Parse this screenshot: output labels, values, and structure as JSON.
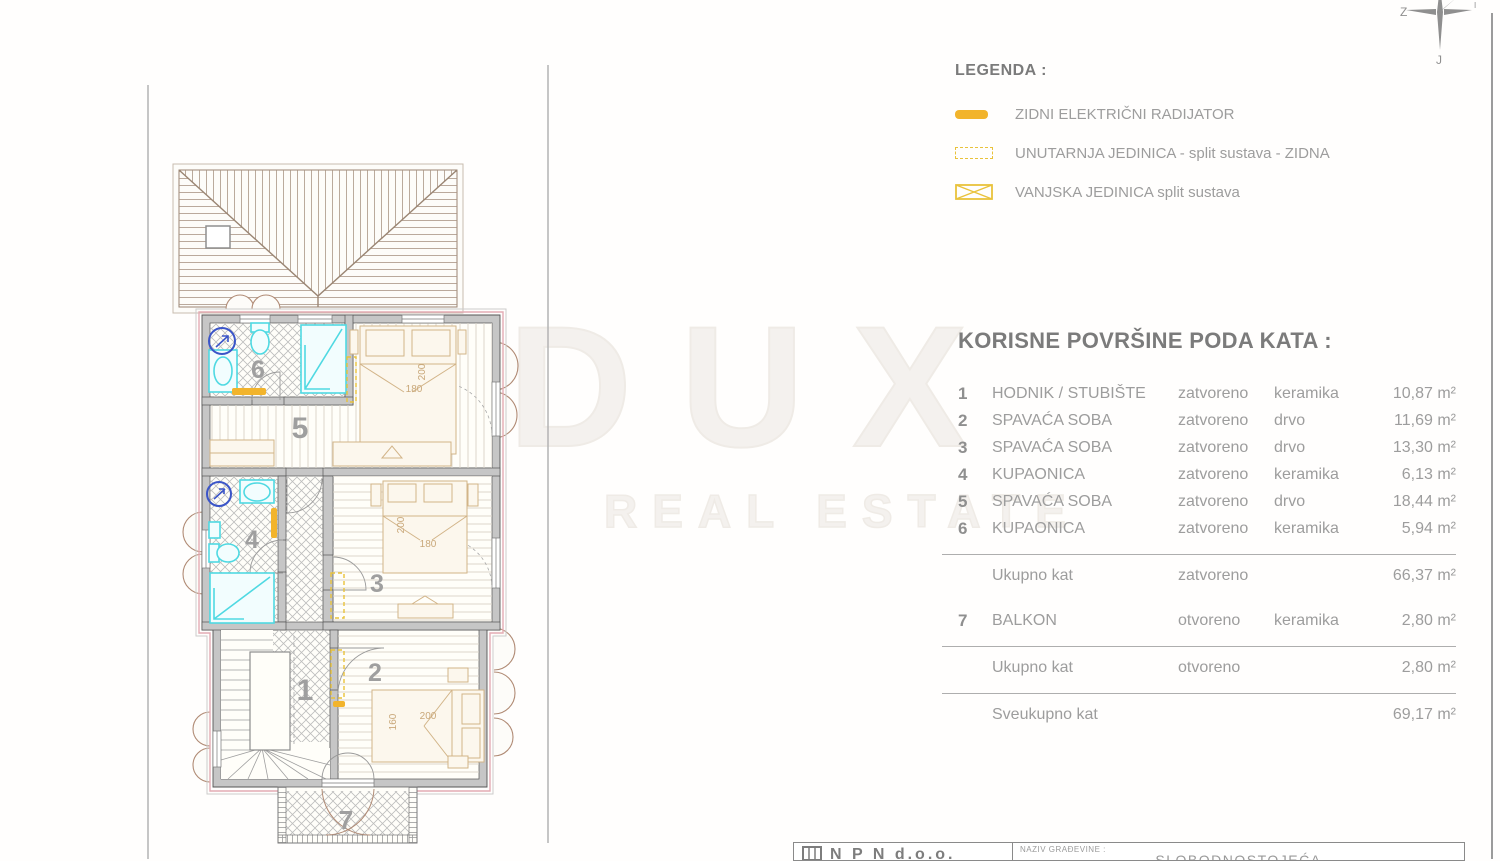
{
  "compass": {
    "west": "Z",
    "south": "J",
    "east": "I"
  },
  "legend": {
    "title": "LEGENDA :",
    "items": [
      {
        "symbol": "radiator-bar",
        "label": "ZIDNI ELEKTRIČNI RADIJATOR"
      },
      {
        "symbol": "dashed-rect",
        "label": "UNUTARNJA JEDINICA - split sustava - ZIDNA"
      },
      {
        "symbol": "crossed-rect",
        "label": "VANJSKA JEDINICA split sustava"
      }
    ],
    "accent_color": "#F2B42C"
  },
  "areas": {
    "title": "KORISNE POVRŠINE PODA KATA :",
    "rows": [
      {
        "num": "1",
        "name": "HODNIK / STUBIŠTE",
        "mode": "zatvoreno",
        "material": "keramika",
        "area": "10,87 m²"
      },
      {
        "num": "2",
        "name": "SPAVAĆA SOBA",
        "mode": "zatvoreno",
        "material": "drvo",
        "area": "11,69 m²"
      },
      {
        "num": "3",
        "name": "SPAVAĆA SOBA",
        "mode": "zatvoreno",
        "material": "drvo",
        "area": "13,30 m²"
      },
      {
        "num": "4",
        "name": "KUPAONICA",
        "mode": "zatvoreno",
        "material": "keramika",
        "area": "6,13 m²"
      },
      {
        "num": "5",
        "name": "SPAVAĆA SOBA",
        "mode": "zatvoreno",
        "material": "drvo",
        "area": "18,44 m²"
      },
      {
        "num": "6",
        "name": "KUPAONICA",
        "mode": "zatvoreno",
        "material": "keramika",
        "area": "5,94 m²"
      }
    ],
    "subtotal_closed": {
      "label": "Ukupno kat",
      "mode": "zatvoreno",
      "area": "66,37 m²"
    },
    "row7": {
      "num": "7",
      "name": "BALKON",
      "mode": "otvoreno",
      "material": "keramika",
      "area": "2,80 m²"
    },
    "subtotal_open": {
      "label": "Ukupno kat",
      "mode": "otvoreno",
      "area": "2,80 m²"
    },
    "total": {
      "label": "Sveukupno kat",
      "area": "69,17 m²"
    }
  },
  "watermark": {
    "line1": "DUX",
    "line2": "REAL ESTATE"
  },
  "plan": {
    "labels": {
      "r1": "1",
      "r2": "2",
      "r3": "3",
      "r4": "4",
      "r5": "5",
      "r6": "6",
      "r7": "7"
    },
    "dims": {
      "bed5_len": "200",
      "bed5_wid": "180",
      "bed3_len": "200",
      "bed3_wid": "180",
      "bed2_wid": "160",
      "bed2_len": "200"
    }
  },
  "title_block": {
    "company": "N P N  d.o.o.",
    "naziv_label": "NAZIV GRAĐEVINE :",
    "naziv_value": "SLOBODNOSTOJEĆA"
  },
  "colors": {
    "accent": "#F2B42C",
    "cyan": "#4FD9E2",
    "wall": "#C6C6C6",
    "pink": "#E4ACB4",
    "text_gray": "#9D9D9D"
  }
}
